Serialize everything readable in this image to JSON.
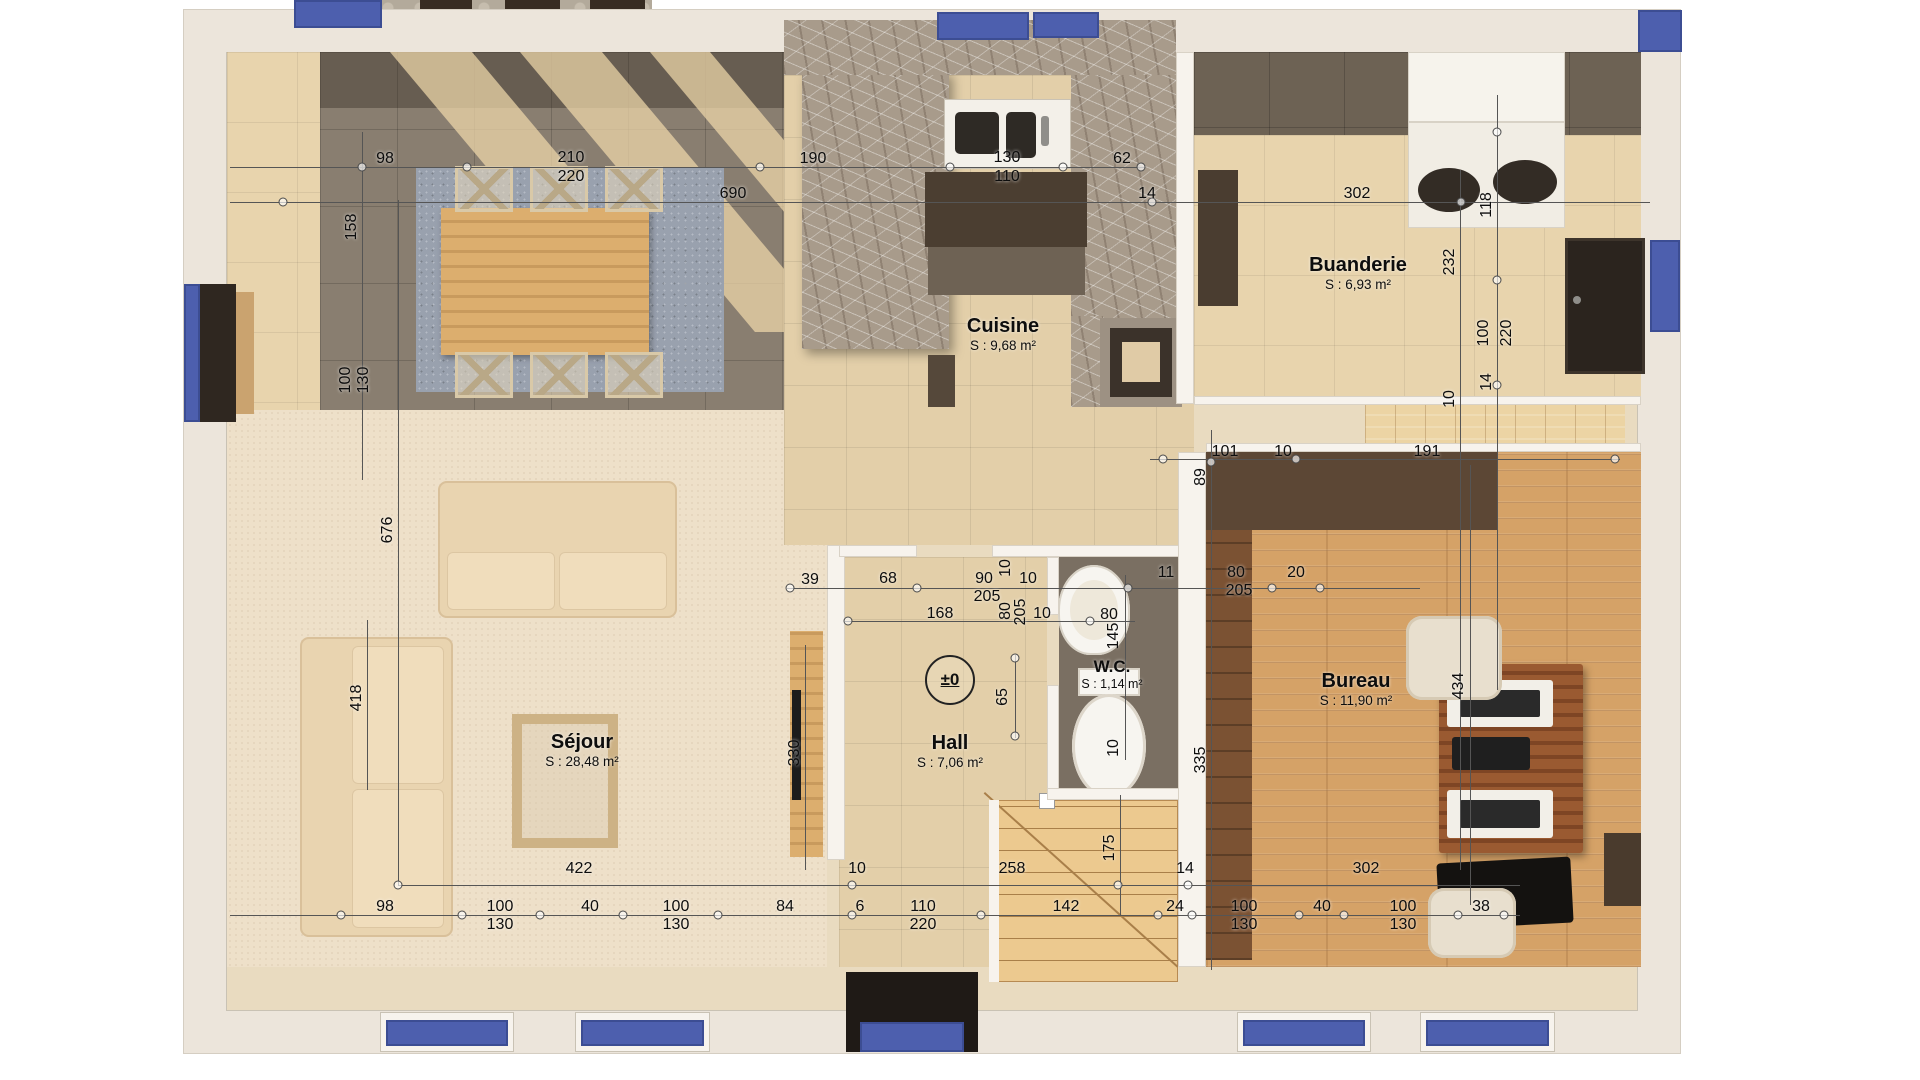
{
  "rooms": {
    "sejour": {
      "name": "Séjour",
      "area": "S : 28,48 m²"
    },
    "cuisine": {
      "name": "Cuisine",
      "area": "S : 9,68 m²"
    },
    "buanderie": {
      "name": "Buanderie",
      "area": "S : 6,93 m²"
    },
    "bureau": {
      "name": "Bureau",
      "area": "S : 11,90 m²"
    },
    "hall": {
      "name": "Hall",
      "area": "S : 7,06 m²"
    },
    "wc": {
      "name": "W.C.",
      "area": "S : 1,14 m²"
    }
  },
  "level_marker": "±0",
  "dims": {
    "top1": [
      "98",
      "210",
      "220",
      "190",
      "130",
      "110",
      "62"
    ],
    "top2": [
      "690",
      "14",
      "302"
    ],
    "right": [
      "118",
      "232",
      "100",
      "220",
      "14",
      "10",
      "191"
    ],
    "left": [
      "158",
      "100",
      "130",
      "676",
      "418"
    ],
    "mid": [
      "101",
      "10",
      "89",
      "335",
      "434",
      "330",
      "65",
      "145",
      "10",
      "175"
    ],
    "hall1": [
      "39",
      "68",
      "90",
      "205",
      "10",
      "10",
      "11",
      "80",
      "205",
      "20"
    ],
    "hall2": [
      "168",
      "80",
      "205",
      "10",
      "80"
    ],
    "row1": [
      "422",
      "10",
      "258",
      "14",
      "302"
    ],
    "row2": [
      "98",
      "100",
      "130",
      "40",
      "100",
      "130",
      "84",
      "6",
      "110",
      "220",
      "142",
      "24",
      "100",
      "130",
      "40",
      "100",
      "130",
      "38"
    ]
  },
  "colors": {
    "accent_blue": "#4d5fae",
    "wall": "#ece5db",
    "floor_beige": "#e3cfa9",
    "floor_gray": "#897e70",
    "marble": "#a89b8b",
    "wood_light": "#dcae6e",
    "wood_desk": "#9a5a31",
    "dim_text": "#0d0d0d"
  }
}
